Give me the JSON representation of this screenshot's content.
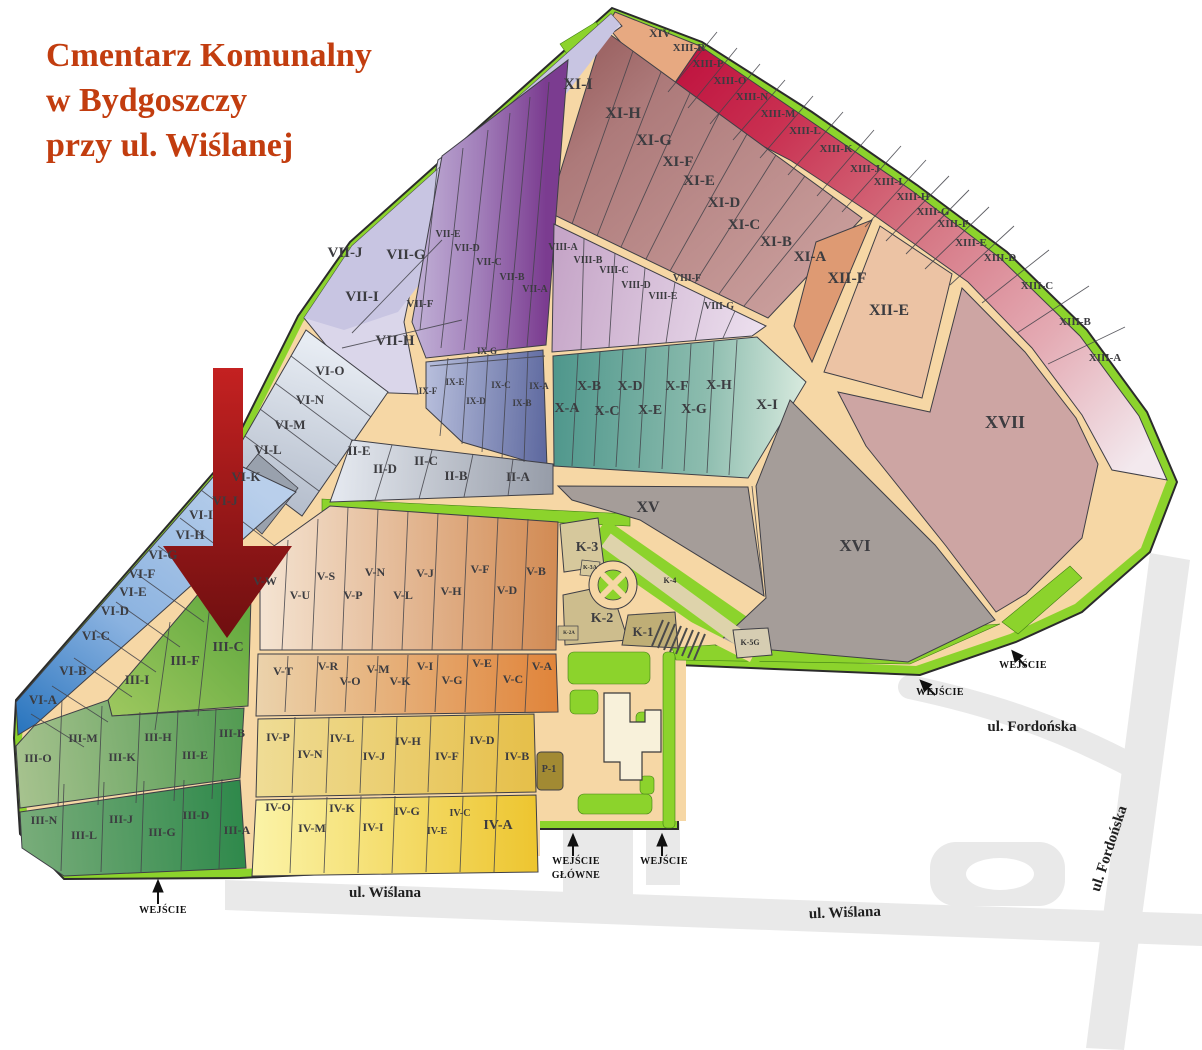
{
  "title": {
    "line1": "Cmentarz Komunalny",
    "line2": "w Bydgoszczy",
    "line3": "przy ul. Wiślanej"
  },
  "colors": {
    "title_text": "#c23d0f",
    "road": "#f6d7a5",
    "green_area": "#8cd32c",
    "street_gray": "#e9e9e9",
    "arrow_red_top": "#c42121",
    "arrow_red_bottom": "#6e0f10",
    "section_13_start": "#c01540",
    "section_13_end": "#f3e9ee",
    "section_10_teal": "#4f978c",
    "section_6_blue": "#2673bd",
    "section_4_yellow": "#edc52f",
    "gray_sections": "#a59d99"
  },
  "annotations": {
    "highlight_arrow_target": "III-C"
  },
  "map": {
    "labels": [
      [
        "XIV",
        660,
        37,
        12
      ],
      [
        "XIII-R",
        689,
        51,
        11
      ],
      [
        "XIII-P",
        708,
        67,
        11
      ],
      [
        "XIII-O",
        730,
        84,
        11
      ],
      [
        "XIII-N",
        752,
        100,
        11
      ],
      [
        "XIII-M",
        778,
        117,
        11
      ],
      [
        "XIII-L",
        805,
        134,
        11
      ],
      [
        "XIII-K",
        836,
        152,
        11
      ],
      [
        "XIII-J",
        865,
        172,
        11
      ],
      [
        "XIII-I",
        888,
        185,
        11
      ],
      [
        "XIII-H",
        913,
        200,
        11
      ],
      [
        "XIII-G",
        933,
        215,
        11
      ],
      [
        "XIII-F",
        953,
        227,
        11
      ],
      [
        "XIII-E",
        971,
        246,
        11
      ],
      [
        "XIII-D",
        1000,
        261,
        11
      ],
      [
        "XIII-C",
        1037,
        289,
        11
      ],
      [
        "XIII-B",
        1075,
        325,
        11
      ],
      [
        "XIII-A",
        1105,
        361,
        11
      ],
      [
        "XI-I",
        578,
        89,
        16
      ],
      [
        "XI-H",
        623,
        118,
        16
      ],
      [
        "XI-G",
        654,
        145,
        16
      ],
      [
        "XI-F",
        678,
        166,
        15
      ],
      [
        "XI-E",
        699,
        185,
        15
      ],
      [
        "XI-D",
        724,
        207,
        15
      ],
      [
        "XI-C",
        744,
        229,
        15
      ],
      [
        "XI-B",
        776,
        246,
        15
      ],
      [
        "XI-A",
        810,
        261,
        15
      ],
      [
        "XII-F",
        847,
        283,
        16
      ],
      [
        "XII-E",
        889,
        315,
        16
      ],
      [
        "XVII",
        1005,
        428,
        18
      ],
      [
        "XVI",
        855,
        551,
        17
      ],
      [
        "XV",
        648,
        512,
        16
      ],
      [
        "VII-J",
        345,
        257,
        15
      ],
      [
        "VII-G",
        406,
        259,
        15
      ],
      [
        "VII-I",
        362,
        301,
        15
      ],
      [
        "VII-F",
        420,
        307,
        11
      ],
      [
        "VII-H",
        395,
        345,
        15
      ],
      [
        "VII-E",
        448,
        237,
        10
      ],
      [
        "VII-D",
        467,
        251,
        10
      ],
      [
        "VII-C",
        489,
        265,
        10
      ],
      [
        "VII-B",
        512,
        280,
        10
      ],
      [
        "VII-A",
        535,
        292,
        10
      ],
      [
        "VIII-A",
        563,
        250,
        10
      ],
      [
        "VIII-B",
        588,
        263,
        10
      ],
      [
        "VIII-C",
        614,
        273,
        10
      ],
      [
        "VIII-D",
        636,
        288,
        10
      ],
      [
        "VIII-E",
        663,
        299,
        10
      ],
      [
        "VIII-F",
        687,
        281,
        10
      ],
      [
        "VIII-G",
        719,
        309,
        10
      ],
      [
        "IX-G",
        487,
        354,
        9
      ],
      [
        "IX-F",
        428,
        394,
        9
      ],
      [
        "IX-E",
        455,
        385,
        9
      ],
      [
        "IX-D",
        476,
        404,
        9
      ],
      [
        "IX-C",
        501,
        388,
        9
      ],
      [
        "IX-B",
        522,
        406,
        9
      ],
      [
        "IX-A",
        539,
        389,
        9
      ],
      [
        "X-B",
        589,
        390,
        14
      ],
      [
        "X-D",
        630,
        390,
        14
      ],
      [
        "X-F",
        677,
        390,
        14
      ],
      [
        "X-H",
        719,
        389,
        14
      ],
      [
        "X-A",
        567,
        412,
        14
      ],
      [
        "X-C",
        607,
        415,
        14
      ],
      [
        "X-E",
        650,
        414,
        14
      ],
      [
        "X-G",
        694,
        413,
        14
      ],
      [
        "X-I",
        767,
        409,
        15
      ],
      [
        "VI-O",
        330,
        375,
        13
      ],
      [
        "VI-N",
        310,
        404,
        13
      ],
      [
        "VI-M",
        290,
        429,
        13
      ],
      [
        "VI-L",
        268,
        454,
        13
      ],
      [
        "VI-K",
        246,
        481,
        13
      ],
      [
        "VI-J",
        225,
        505,
        13
      ],
      [
        "VI-I",
        201,
        519,
        13
      ],
      [
        "VI-H",
        190,
        539,
        13
      ],
      [
        "VI-G",
        163,
        559,
        13
      ],
      [
        "VI-F",
        142,
        578,
        13
      ],
      [
        "VI-E",
        133,
        596,
        13
      ],
      [
        "VI-D",
        115,
        615,
        13
      ],
      [
        "VI-C",
        96,
        640,
        13
      ],
      [
        "VI-B",
        73,
        675,
        13
      ],
      [
        "VI-A",
        43,
        704,
        13
      ],
      [
        "II-E",
        359,
        455,
        13
      ],
      [
        "II-D",
        385,
        473,
        13
      ],
      [
        "II-C",
        426,
        465,
        13
      ],
      [
        "II-B",
        456,
        480,
        13
      ],
      [
        "II-A",
        518,
        481,
        13
      ],
      [
        "K-3",
        587,
        551,
        14
      ],
      [
        "K-3A",
        590,
        569,
        6,
        "small"
      ],
      [
        "K-2",
        602,
        622,
        14
      ],
      [
        "K-2A",
        569,
        634,
        5,
        "small"
      ],
      [
        "K-1",
        643,
        636,
        13
      ],
      [
        "K-4",
        670,
        583,
        8,
        "small"
      ],
      [
        "K-5G",
        750,
        645,
        8,
        "small"
      ],
      [
        "V-W",
        265,
        585,
        12
      ],
      [
        "V-U",
        300,
        599,
        12
      ],
      [
        "V-S",
        326,
        580,
        12
      ],
      [
        "V-P",
        353,
        599,
        12
      ],
      [
        "V-N",
        375,
        576,
        12
      ],
      [
        "V-L",
        403,
        599,
        12
      ],
      [
        "V-J",
        425,
        577,
        12
      ],
      [
        "V-H",
        451,
        595,
        12
      ],
      [
        "V-F",
        480,
        573,
        12
      ],
      [
        "V-D",
        507,
        594,
        12
      ],
      [
        "V-B",
        536,
        575,
        12
      ],
      [
        "V-T",
        283,
        675,
        12
      ],
      [
        "V-R",
        328,
        670,
        12
      ],
      [
        "V-O",
        350,
        685,
        12
      ],
      [
        "V-M",
        378,
        673,
        12
      ],
      [
        "V-K",
        400,
        685,
        12
      ],
      [
        "V-I",
        425,
        670,
        12
      ],
      [
        "V-G",
        452,
        684,
        12
      ],
      [
        "V-E",
        482,
        667,
        12
      ],
      [
        "V-C",
        513,
        683,
        12
      ],
      [
        "V-A",
        542,
        670,
        12
      ],
      [
        "IV-P",
        278,
        741,
        12
      ],
      [
        "IV-N",
        310,
        758,
        12
      ],
      [
        "IV-L",
        342,
        742,
        12
      ],
      [
        "IV-J",
        374,
        760,
        12
      ],
      [
        "IV-H",
        408,
        745,
        12
      ],
      [
        "IV-F",
        447,
        760,
        12
      ],
      [
        "IV-D",
        482,
        744,
        12
      ],
      [
        "IV-B",
        517,
        760,
        12
      ],
      [
        "P-1",
        549,
        772,
        10
      ],
      [
        "IV-O",
        278,
        811,
        12
      ],
      [
        "IV-M",
        312,
        832,
        12
      ],
      [
        "IV-K",
        342,
        812,
        12
      ],
      [
        "IV-I",
        373,
        831,
        12
      ],
      [
        "IV-G",
        407,
        815,
        12
      ],
      [
        "IV-E",
        437,
        834,
        10
      ],
      [
        "IV-C",
        460,
        816,
        10
      ],
      [
        "IV-A",
        498,
        829,
        14
      ],
      [
        "III-I",
        137,
        684,
        13
      ],
      [
        "III-F",
        185,
        665,
        14
      ],
      [
        "III-C",
        228,
        651,
        14
      ],
      [
        "III-O",
        38,
        762,
        12
      ],
      [
        "III-M",
        83,
        742,
        12
      ],
      [
        "III-K",
        122,
        761,
        12
      ],
      [
        "III-H",
        158,
        741,
        12
      ],
      [
        "III-E",
        195,
        759,
        12
      ],
      [
        "III-B",
        232,
        737,
        12
      ],
      [
        "III-N",
        44,
        824,
        12
      ],
      [
        "III-L",
        84,
        839,
        12
      ],
      [
        "III-J",
        121,
        823,
        12
      ],
      [
        "III-G",
        162,
        836,
        12
      ],
      [
        "III-D",
        196,
        819,
        12
      ],
      [
        "III-A",
        237,
        834,
        12
      ],
      [
        "WEJŚCIE",
        163,
        913,
        10,
        "entrance"
      ],
      [
        "WEJŚCIE",
        576,
        864,
        10,
        "entrance"
      ],
      [
        "GŁÓWNE",
        576,
        878,
        10,
        "entrance"
      ],
      [
        "WEJŚCIE",
        664,
        864,
        10,
        "entrance"
      ],
      [
        "WEJŚCIE",
        940,
        695,
        10,
        "entrance"
      ],
      [
        "WEJŚCIE",
        1023,
        668,
        10,
        "entrance"
      ],
      [
        "ul. Wiślana",
        385,
        897,
        15,
        "street"
      ],
      [
        "ul. Wiślana",
        845,
        917,
        15,
        "street",
        -2
      ],
      [
        "ul. Fordońska",
        1032,
        731,
        15,
        "street"
      ],
      [
        "ul. Fordońska",
        1113,
        850,
        15,
        "street",
        -72
      ]
    ]
  }
}
